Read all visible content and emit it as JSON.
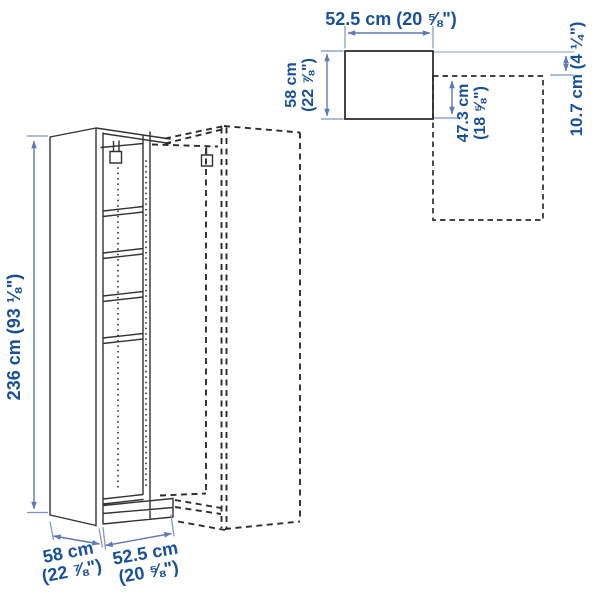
{
  "colors": {
    "label_text": "#17509e",
    "dimension_line": "#5d79b6",
    "artwork_line": "#333333",
    "background": "#ffffff"
  },
  "front_view": {
    "height_label": "236 cm (93 ⅛\")",
    "depth_label": [
      "58 cm",
      "(22 ⅞\")"
    ],
    "width_label": [
      "52.5 cm",
      "(20 ⅝\")"
    ]
  },
  "top_view": {
    "width_label": "52.5 cm (20 ⅝\")",
    "depth_label": [
      "58 cm",
      "(22 ⅞\")"
    ],
    "interior_depth_label": [
      "47.3 cm",
      "(18 ⅝\")"
    ],
    "offset_label": "10.7 cm (4 ¼\")"
  }
}
